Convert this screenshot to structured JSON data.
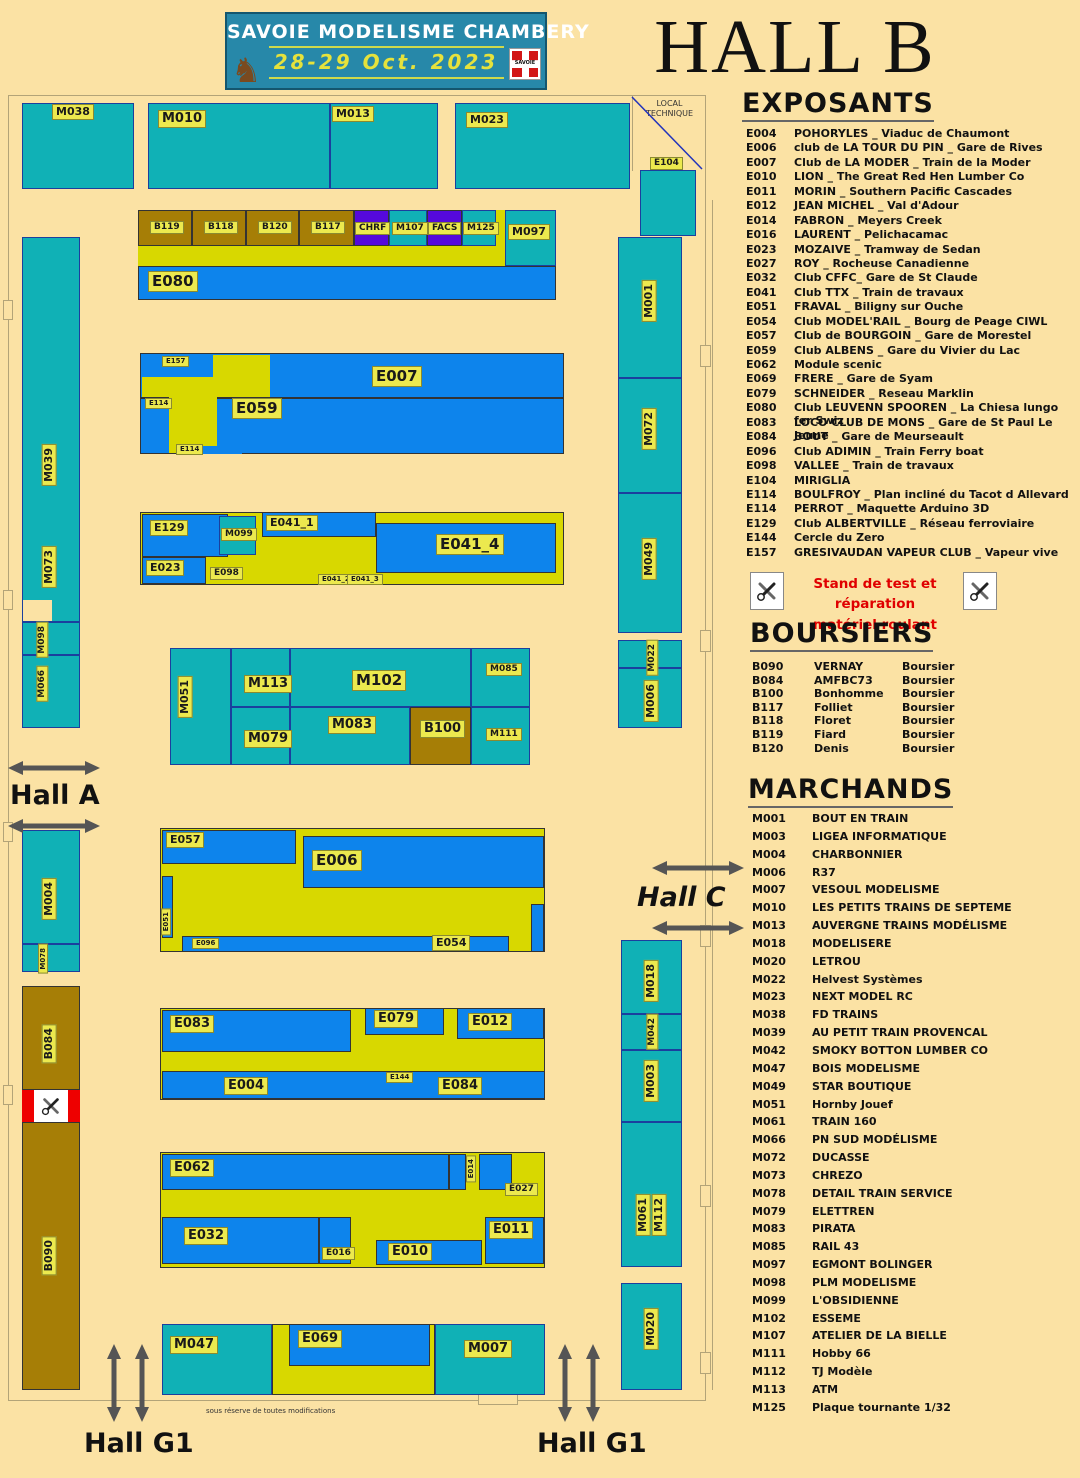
{
  "banner": {
    "title": "SAVOIE MODELISME CHAMBERY",
    "dates": "28-29 Oct. 2023",
    "logo_text": "SAVOIE"
  },
  "hall_title": "HALL B",
  "panel": {
    "exposants": {
      "title": "EXPOSANTS",
      "items": [
        {
          "code": "E004",
          "name": "POHORYLES _ Viaduc de Chaumont"
        },
        {
          "code": "E006",
          "name": "club de LA TOUR DU PIN _ Gare de Rives"
        },
        {
          "code": "E007",
          "name": "Club de LA MODER _ Train de la Moder"
        },
        {
          "code": "E010",
          "name": "LION _ The Great Red Hen Lumber Co"
        },
        {
          "code": "E011",
          "name": "MORIN _ Southern Pacific Cascades"
        },
        {
          "code": "E012",
          "name": "JEAN MICHEL _ Val d'Adour"
        },
        {
          "code": "E014",
          "name": "FABRON _ Meyers Creek"
        },
        {
          "code": "E016",
          "name": "LAURENT _ Pelichacamac"
        },
        {
          "code": "E023",
          "name": "MOZAIVE _ Tramway de Sedan"
        },
        {
          "code": "E027",
          "name": "ROY _ Rocheuse Canadienne"
        },
        {
          "code": "E032",
          "name": "Club CFFC_ Gare de St Claude"
        },
        {
          "code": "E041",
          "name": "Club TTX _ Train de travaux"
        },
        {
          "code": "E051",
          "name": "FRAVAL _ Biligny sur Ouche"
        },
        {
          "code": "E054",
          "name": "Club MODEL'RAIL _ Bourg de Peage CIWL"
        },
        {
          "code": "E057",
          "name": "Club de BOURGOIN _ Gare de Morestel"
        },
        {
          "code": "E059",
          "name": "Club ALBENS _ Gare du Vivier du Lac"
        },
        {
          "code": "E062",
          "name": "Module scenic"
        },
        {
          "code": "E069",
          "name": "FRERE _ Gare de Syam"
        },
        {
          "code": "E079",
          "name": "SCHNEIDER _ Reseau Marklin"
        },
        {
          "code": "E080",
          "name": "Club LEUVENN SPOOREN _ La Chiesa lungo fer Swiz"
        },
        {
          "code": "E083",
          "name": "LOCO CLUB DE MONS _ Gare de St Paul Le Jeune"
        },
        {
          "code": "E084",
          "name": "BOUT _ Gare de Meurseault"
        },
        {
          "code": "E096",
          "name": "Club ADIMIN _ Train Ferry boat"
        },
        {
          "code": "E098",
          "name": "VALLEE _ Train de travaux"
        },
        {
          "code": "E104",
          "name": "MIRIGLIA"
        },
        {
          "code": "E114",
          "name": "BOULFROY _ Plan incliné du Tacot d Allevard"
        },
        {
          "code": "E114",
          "name": "PERROT _ Maquette Arduino 3D"
        },
        {
          "code": "E129",
          "name": "Club ALBERTVILLE _ Réseau ferroviaire"
        },
        {
          "code": "E144",
          "name": "Cercle du Zero"
        },
        {
          "code": "E157",
          "name": "GRESIVAUDAN VAPEUR CLUB _ Vapeur vive"
        }
      ]
    },
    "stand_test": {
      "line1": "Stand de test et réparation",
      "line2": "matériel roulant"
    },
    "boursiers": {
      "title": "BOURSIERS",
      "items": [
        {
          "code": "B090",
          "name": "VERNAY",
          "role": "Boursier"
        },
        {
          "code": "B084",
          "name": "AMFBC73",
          "role": "Boursier"
        },
        {
          "code": "B100",
          "name": "Bonhomme",
          "role": "Boursier"
        },
        {
          "code": "B117",
          "name": "Folliet",
          "role": "Boursier"
        },
        {
          "code": "B118",
          "name": "Floret",
          "role": "Boursier"
        },
        {
          "code": "B119",
          "name": "Fiard",
          "role": "Boursier"
        },
        {
          "code": "B120",
          "name": "Denis",
          "role": "Boursier"
        }
      ]
    },
    "marchands": {
      "title": "MARCHANDS",
      "items": [
        {
          "code": "M001",
          "name": "BOUT EN TRAIN"
        },
        {
          "code": "M003",
          "name": "LIGEA INFORMATIQUE"
        },
        {
          "code": "M004",
          "name": "CHARBONNIER"
        },
        {
          "code": "M006",
          "name": "R37"
        },
        {
          "code": "M007",
          "name": "VESOUL MODELISME"
        },
        {
          "code": "M010",
          "name": "LES PETITS TRAINS DE SEPTEME"
        },
        {
          "code": "M013",
          "name": "AUVERGNE TRAINS MODÉLISME"
        },
        {
          "code": "M018",
          "name": "MODELISERE"
        },
        {
          "code": "M020",
          "name": "LETROU"
        },
        {
          "code": "M022",
          "name": "Helvest Systèmes"
        },
        {
          "code": "M023",
          "name": "NEXT MODEL RC"
        },
        {
          "code": "M038",
          "name": "FD TRAINS"
        },
        {
          "code": "M039",
          "name": "AU PETIT TRAIN PROVENCAL"
        },
        {
          "code": "M042",
          "name": "SMOKY BOTTON LUMBER CO"
        },
        {
          "code": "M047",
          "name": "BOIS MODELISME"
        },
        {
          "code": "M049",
          "name": "STAR BOUTIQUE"
        },
        {
          "code": "M051",
          "name": "Hornby Jouef"
        },
        {
          "code": "M061",
          "name": "TRAIN 160"
        },
        {
          "code": "M066",
          "name": "PN SUD MODÉLISME"
        },
        {
          "code": "M072",
          "name": "DUCASSE"
        },
        {
          "code": "M073",
          "name": "CHREZO"
        },
        {
          "code": "M078",
          "name": "DETAIL TRAIN SERVICE"
        },
        {
          "code": "M079",
          "name": "ELETTREN"
        },
        {
          "code": "M083",
          "name": "PIRATA"
        },
        {
          "code": "M085",
          "name": "RAIL 43"
        },
        {
          "code": "M097",
          "name": "EGMONT BOLINGER"
        },
        {
          "code": "M098",
          "name": "PLM MODELISME"
        },
        {
          "code": "M099",
          "name": "L'OBSIDIENNE"
        },
        {
          "code": "M102",
          "name": "ESSEME"
        },
        {
          "code": "M107",
          "name": "ATELIER DE LA BIELLE"
        },
        {
          "code": "M111",
          "name": "Hobby 66"
        },
        {
          "code": "M112",
          "name": "TJ Modèle"
        },
        {
          "code": "M113",
          "name": "ATM"
        },
        {
          "code": "M125",
          "name": "Plaque tournante 1/32"
        }
      ]
    }
  },
  "plan": {
    "local_technique": "LOCAL TECHNIQUE",
    "disclaimer": "sous réserve de toutes modifications",
    "hall_a": "Hall A",
    "hall_c": "Hall C",
    "hall_g1": "Hall G1",
    "stands": {
      "m038": "M038",
      "m010": "M010",
      "m013": "M013",
      "m023": "M023",
      "e104": "E104",
      "b119": "B119",
      "b118": "B118",
      "b120": "B120",
      "b117": "B117",
      "chrf": "CHRF",
      "m107": "M107",
      "facs": "FACS",
      "m125": "M125",
      "m097": "M097",
      "e080": "E080",
      "e157": "E157",
      "e007": "E007",
      "e114": "E114",
      "e059": "E059",
      "e129": "E129",
      "m099": "M099",
      "e041_1": "E041_1",
      "e041_4": "E041_4",
      "e023": "E023",
      "e098": "E098",
      "e041_2": "E041_2",
      "e041_3": "E041_3",
      "m051": "M051",
      "m113": "M113",
      "m102": "M102",
      "m085": "M085",
      "m079": "M079",
      "m083": "M083",
      "b100": "B100",
      "m111": "M111",
      "e057": "E057",
      "e006": "E006",
      "e051": "E051",
      "e096": "E096",
      "e054": "E054",
      "e083": "E083",
      "e079": "E079",
      "e012": "E012",
      "e004": "E004",
      "e144": "E144",
      "e084": "E084",
      "e062": "E062",
      "e014": "E014",
      "e027": "E027",
      "e032": "E032",
      "e016": "E016",
      "e010": "E010",
      "e011": "E011",
      "m047": "M047",
      "e069": "E069",
      "m007": "M007",
      "m039": "M039",
      "m073": "M073",
      "m098": "M098",
      "m066": "M066",
      "m004": "M004",
      "m078": "M078",
      "b084": "B084",
      "b090": "B090",
      "m001": "M001",
      "m072": "M072",
      "m049": "M049",
      "m022": "M022",
      "m006": "M006",
      "m018": "M018",
      "m042": "M042",
      "m003": "M003",
      "m061": "M061",
      "m112": "M112",
      "m020": "M020"
    }
  }
}
